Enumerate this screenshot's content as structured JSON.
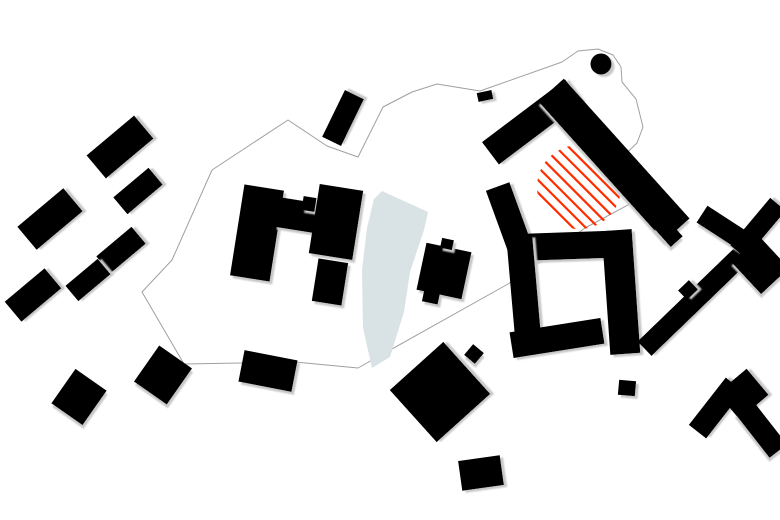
{
  "plan": {
    "canvas": {
      "width": 780,
      "height": 520,
      "background": "#ffffff"
    },
    "palette": {
      "building": "#000000",
      "shadow": "#c8c8c8",
      "boundary_line": "#a0a0a0",
      "pond": "#d9e2e5",
      "hatch_red": "#ff2e00"
    },
    "boundary": {
      "closed": true,
      "points": [
        [
          437,
          84
        ],
        [
          480,
          91
        ],
        [
          562,
          62
        ],
        [
          578,
          51
        ],
        [
          598,
          49
        ],
        [
          613,
          55
        ],
        [
          621,
          67
        ],
        [
          622,
          82
        ],
        [
          636,
          99
        ],
        [
          643,
          127
        ],
        [
          637,
          143
        ],
        [
          611,
          168
        ],
        [
          641,
          198
        ],
        [
          585,
          228
        ],
        [
          508,
          284
        ],
        [
          358,
          368
        ],
        [
          295,
          362
        ],
        [
          184,
          364
        ],
        [
          142,
          292
        ],
        [
          172,
          260
        ],
        [
          212,
          170
        ],
        [
          288,
          120
        ],
        [
          327,
          146
        ],
        [
          358,
          157
        ],
        [
          383,
          107
        ],
        [
          412,
          92
        ]
      ]
    },
    "pond": {
      "points": [
        [
          382,
          191
        ],
        [
          428,
          212
        ],
        [
          424,
          230
        ],
        [
          410,
          272
        ],
        [
          404,
          312
        ],
        [
          390,
          357
        ],
        [
          372,
          368
        ],
        [
          363,
          328
        ],
        [
          362,
          270
        ],
        [
          367,
          228
        ],
        [
          374,
          199
        ]
      ]
    },
    "hatch_area": {
      "cx": 579,
      "cy": 187,
      "r": 42,
      "angle_deg": 45,
      "spacing": 9,
      "stroke_width": 2.2
    },
    "circle_building": {
      "cx": 601,
      "cy": 64,
      "r": 10.5
    },
    "building_format": "cx, cy, width, height, rotation_deg (clockwise)",
    "buildings": [
      [
        120,
        147,
        62,
        30,
        -40
      ],
      [
        138,
        191,
        46,
        22,
        -40
      ],
      [
        50,
        219,
        60,
        30,
        -40
      ],
      [
        121,
        250,
        46,
        22,
        -40
      ],
      [
        88,
        280,
        42,
        20,
        -40
      ],
      [
        33,
        295,
        52,
        26,
        -40
      ],
      [
        163,
        375,
        40,
        44,
        35
      ],
      [
        79,
        397,
        38,
        42,
        35
      ],
      [
        343,
        118,
        52,
        21,
        -64
      ],
      [
        485,
        96,
        15,
        9,
        -12
      ],
      [
        257,
        233,
        40,
        92,
        9
      ],
      [
        296,
        215,
        40,
        30,
        9
      ],
      [
        309,
        204,
        13,
        14,
        9
      ],
      [
        336,
        222,
        44,
        70,
        9
      ],
      [
        330,
        282,
        30,
        43,
        9
      ],
      [
        444,
        271,
        46,
        48,
        12
      ],
      [
        431,
        297,
        16,
        12,
        12
      ],
      [
        447,
        244,
        12,
        10,
        12
      ],
      [
        474,
        354,
        14,
        14,
        40
      ],
      [
        532,
        122,
        104,
        28,
        -37
      ],
      [
        614,
        160,
        188,
        34,
        48
      ],
      [
        668,
        232,
        26,
        16,
        48
      ],
      [
        512,
        226,
        25,
        84,
        -20
      ],
      [
        561,
        246,
        100,
        27,
        -2
      ],
      [
        524,
        291,
        26,
        110,
        -5
      ],
      [
        557,
        338,
        92,
        26,
        -9
      ],
      [
        621,
        292,
        30,
        124,
        -4
      ],
      [
        627,
        388,
        17,
        15,
        5
      ],
      [
        440,
        392,
        72,
        70,
        -42
      ],
      [
        481,
        473,
        42,
        30,
        -8
      ],
      [
        268,
        371,
        54,
        32,
        11
      ],
      [
        696,
        299,
        143,
        20,
        -44
      ],
      [
        688,
        290,
        15,
        13,
        -44
      ],
      [
        728,
        231,
        62,
        20,
        33
      ],
      [
        758,
        228,
        62,
        20,
        -50
      ],
      [
        760,
        265,
        44,
        38,
        47
      ],
      [
        716,
        408,
        60,
        22,
        -52
      ],
      [
        743,
        394,
        38,
        34,
        -40
      ],
      [
        761,
        429,
        56,
        22,
        52
      ]
    ]
  }
}
